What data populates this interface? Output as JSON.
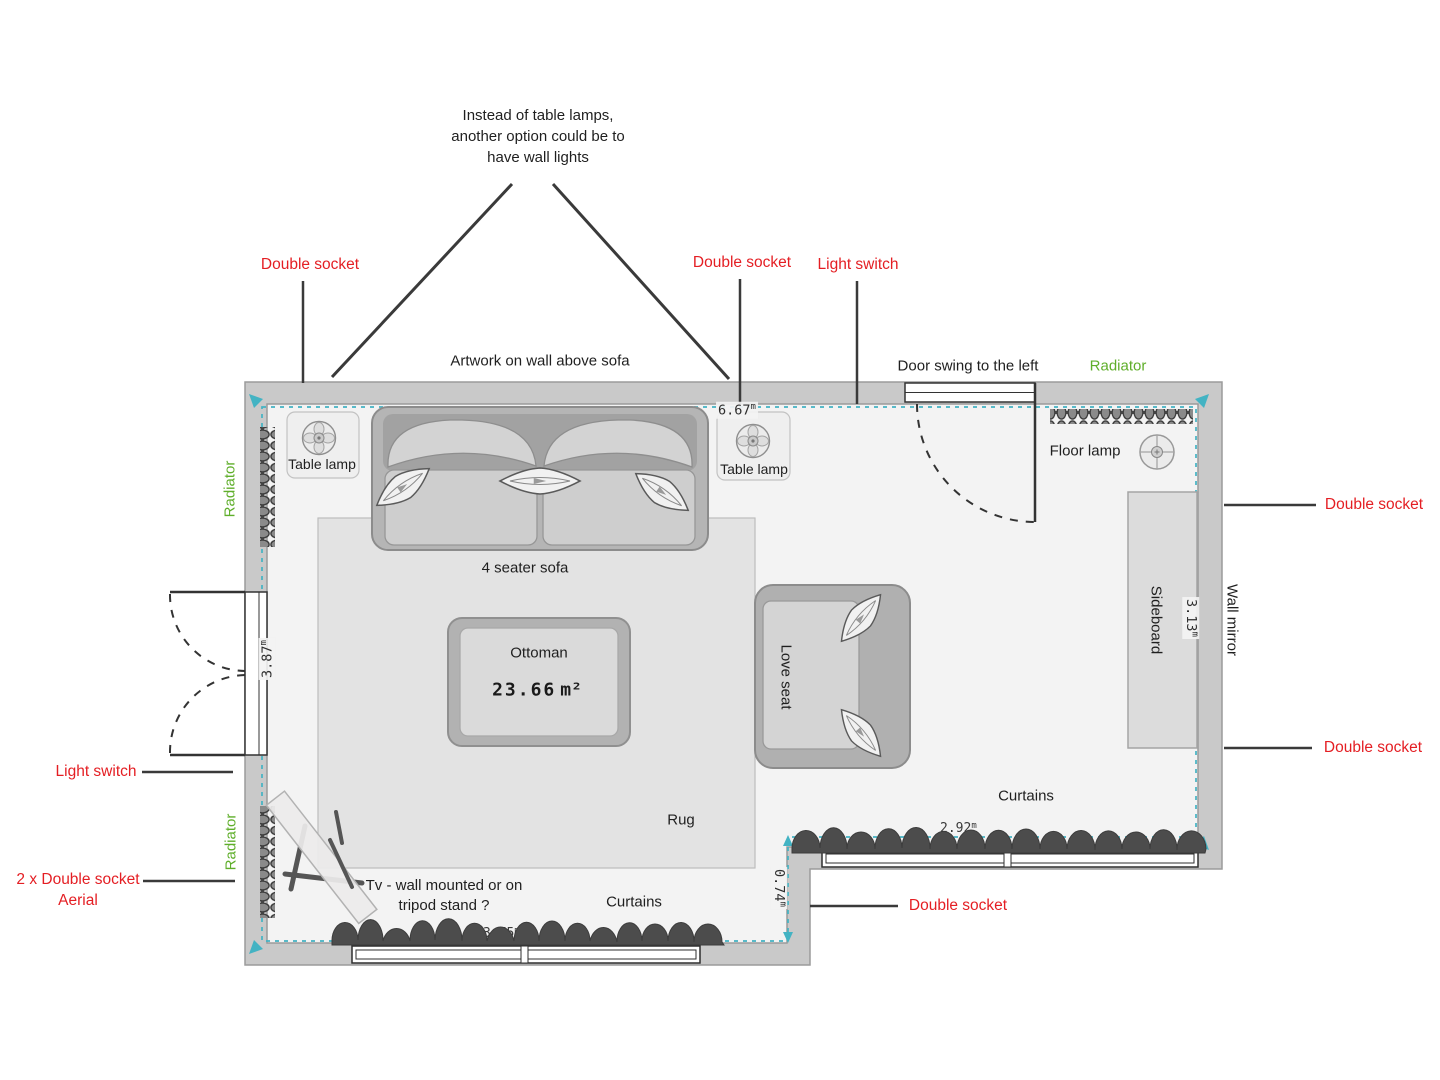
{
  "colors": {
    "annotation_red": "#e41e23",
    "annotation_green": "#5fae2a",
    "boundary_teal": "#43b3c3"
  },
  "labels": {
    "double_socket": "Double socket",
    "light_switch": "Light switch",
    "aerial_socket_line1": "2 x Double socket",
    "aerial_socket_line2": "Aerial",
    "radiator": "Radiator"
  },
  "notes": {
    "lamp_note_1": "Instead of table lamps,",
    "lamp_note_2": "another option could be to",
    "lamp_note_3": "have wall lights",
    "artwork": "Artwork on wall above sofa",
    "door_swing": "Door swing to the left",
    "tv_note_1": "Tv - wall mounted or on",
    "tv_note_2": "tripod stand ?"
  },
  "furniture": {
    "sofa": "4 seater sofa",
    "ottoman": "Ottoman",
    "love_seat": "Love seat",
    "rug": "Rug",
    "sideboard": "Sideboard",
    "wall_mirror": "Wall mirror",
    "table_lamp": "Table lamp",
    "floor_lamp": "Floor lamp",
    "curtains": "Curtains"
  },
  "dimensions": {
    "room_width_top": {
      "value": "6.67",
      "unit": "m"
    },
    "room_height_left": {
      "value": "3.87",
      "unit": "m"
    },
    "room_height_right": {
      "value": "3.13",
      "unit": "m"
    },
    "step_depth": {
      "value": "0.74",
      "unit": "m"
    },
    "window_bottom_width": {
      "value": "3.75",
      "unit": "m"
    },
    "window_right_width": {
      "value": "2.92",
      "unit": "m"
    },
    "floor_area": {
      "value": "23.66",
      "unit": "m²"
    }
  }
}
